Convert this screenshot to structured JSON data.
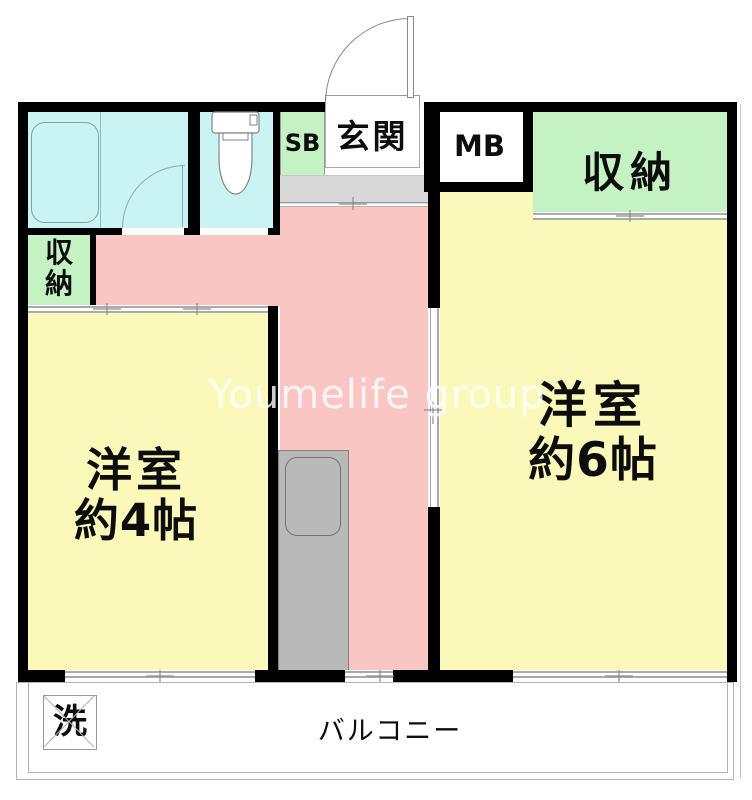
{
  "colors": {
    "wall": "#000000",
    "room-cyan": "#c9f4f3",
    "room-green": "#c5f2c2",
    "room-pink": "#f9c6c3",
    "room-yellow": "#fbf9ba",
    "step-gray": "#d8d8d8",
    "counter-gray": "#b9b9b9",
    "watermark-color": "#ffffff"
  },
  "rooms": {
    "entrance": {
      "label": "玄関"
    },
    "shoe_box": {
      "label": "SB"
    },
    "meter_box": {
      "label": "MB"
    },
    "storage_main": {
      "label": "収納"
    },
    "storage_small": {
      "label": "収納"
    },
    "western_room_6": {
      "label_line1": "洋室",
      "label_line2": "約6帖"
    },
    "western_room_4": {
      "label_line1": "洋室",
      "label_line2": "約4帖"
    },
    "balcony": {
      "label": "バルコニー"
    },
    "washing_machine": {
      "label": "洗"
    }
  },
  "watermark": "Youmelife group"
}
